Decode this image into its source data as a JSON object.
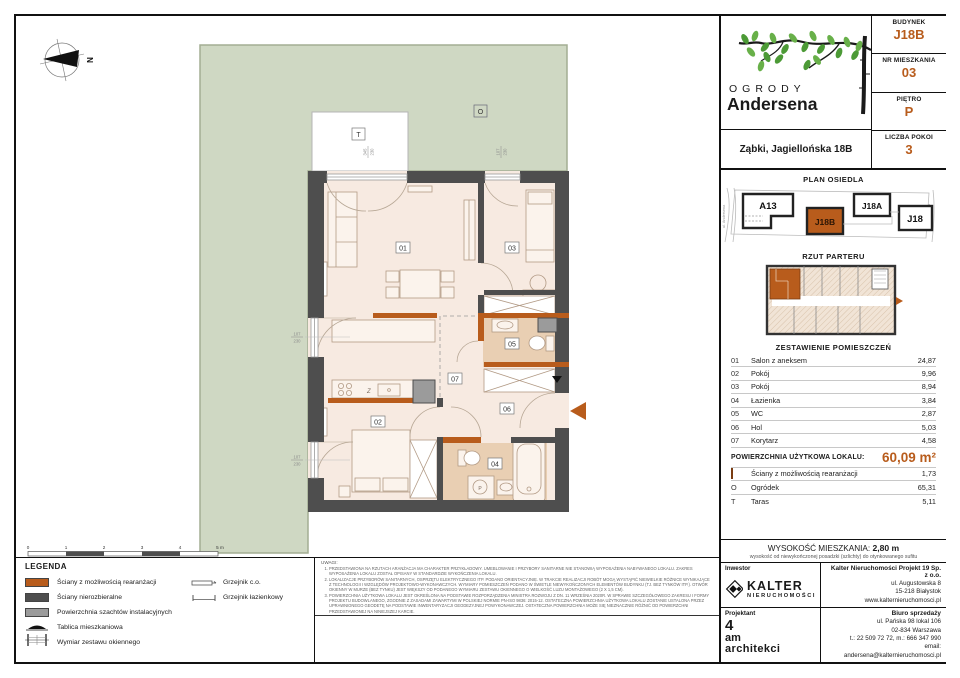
{
  "colors": {
    "accent": "#b85c1c",
    "wall": "#4e4e4e",
    "shaft": "#9b9b9b",
    "floor": "#f7eae1",
    "wet_floor": "#e9cfb3",
    "garden": "#cfd8c3"
  },
  "header": {
    "brand_top": "OGRODY",
    "brand_bottom": "Andersena",
    "address": "Ząbki, Jagiellońska 18B",
    "info": [
      {
        "label": "BUDYNEK",
        "value": "J18B"
      },
      {
        "label": "NR MIESZKANIA",
        "value": "03"
      },
      {
        "label": "PIĘTRO",
        "value": "P"
      },
      {
        "label": "LICZBA POKOI",
        "value": "3"
      }
    ]
  },
  "site_plan": {
    "title": "PLAN OSIEDLA",
    "street_left": "ul. Andersena",
    "street_right": "ul. Jagiellońska",
    "buildings": [
      "A13",
      "J18B",
      "J18A",
      "J18"
    ],
    "highlighted": "J18B"
  },
  "floor_overview": {
    "title": "RZUT PARTERU"
  },
  "rooms_table": {
    "title": "ZESTAWIENIE POMIESZCZEŃ",
    "rows": [
      {
        "no": "01",
        "name": "Salon z aneksem",
        "area": "24,87"
      },
      {
        "no": "02",
        "name": "Pokój",
        "area": "9,96"
      },
      {
        "no": "03",
        "name": "Pokój",
        "area": "8,94"
      },
      {
        "no": "04",
        "name": "Łazienka",
        "area": "3,84"
      },
      {
        "no": "05",
        "name": "WC",
        "area": "2,87"
      },
      {
        "no": "06",
        "name": "Hol",
        "area": "5,03"
      },
      {
        "no": "07",
        "name": "Korytarz",
        "area": "4,58"
      }
    ],
    "total_label": "POWIERZCHNIA UŻYTKOWA LOKALU:",
    "total_value": "60,09 m²",
    "extra_rows": [
      {
        "symbol": "",
        "label": "Ściany z możliwością rearanżacji",
        "area": "1,73"
      },
      {
        "symbol": "O",
        "label": "Ogródek",
        "area": "65,31"
      },
      {
        "symbol": "T",
        "label": "Taras",
        "area": "5,11"
      }
    ]
  },
  "height_note": {
    "label": "WYSOKOŚĆ MIESZKANIA:",
    "value": "2,80 m",
    "subtitle": "wysokość od niewykończonej posadzki (szlichty) do otynkowanego sufitu"
  },
  "footer": {
    "investor_label": "Inwestor",
    "designer_label": "Projektant",
    "kalter_name": "KALTER",
    "kalter_sub": "nieruchomości",
    "designer_lines": [
      "4",
      "am",
      "architekci"
    ],
    "company_name": "Kalter Nieruchomości Projekt 19 Sp. z o.o.",
    "company_lines": [
      "ul. Augustowska 8",
      "15-218 Białystok",
      "www.kalternieruchomosci.pl"
    ],
    "sales_name": "Biuro sprzedaży",
    "sales_lines": [
      "ul. Pańska 98 lokal 106",
      "02-834 Warszawa",
      "t.: 22 509 72 72, m.: 666 347 990",
      "email: andersena@kalternieruchomosci.pl"
    ]
  },
  "legend": {
    "title": "LEGENDA",
    "items": [
      "Ściany z możliwością rearanżacji",
      "Ściany nierozbieralne",
      "Powierzchnia szachtów instalacyjnych",
      "Tablica mieszkaniowa",
      "Wymiar zestawu okiennego"
    ],
    "radiators": [
      "Grzejnik c.o.",
      "Grzejnik łazienkowy"
    ]
  },
  "notes": {
    "title": "UWAGI:",
    "items": [
      "Przedstawiona na rzutach aranżacja ma charakter przykładowy. Umeblowanie i przybory sanitarne nie stanowią wyposażenia nabywanego lokalu. Zakres wyposażenia lokalu został opisany w standardzie wykończenia lokalu.",
      "Lokalizacje przyborów sanitarnych, osprzętu elektrycznego itp. podano orientacyjnie. W trakcie realizacji robót mogą wystąpić niewielkie różnice wynikające z technologii i względów projektowo-wykonawczych. Wymiary pomieszczeń podano w świetle niewykończonych elementów budynku (tj. bez tynków itp.). Otwór okienny w murze (bez tynku) jest większy od podanego wymiaru zestawu okiennego o wielkość luzu montażowego (2 x 1,5 cm).",
      "Powierzchnia użytkowa lokalu jest określona na podstawie Rozporządzenia Ministra Rozwoju z dn. 11 września 2020r. w sprawie szczegółowego zakresu i formy projektu budowlanego, zgodnie z zasadami zawartymi w Polskiej Normie PN-ISO 9836: 2015-12. Ostateczna powierzchnia użytkowa lokalu zostanie ustalona przez uprawnionego geodetę na podstawie inwentaryzacji geodezyjnej powykonawczej. Ostateczna powierzchnia może się nieznacznie różnić od powierzchni przedstawionej na niniejszej karcie.",
      "Niniejsza karta katalogowa została opracowana na podstawie projektu architektoniczno-budowlanego – nie stanowi ona wiernego odwzorowania powstałego lokalu mieszkalnego, a ma jedynie służyć wskazaniu uproszczonej aranżacji lokalu i jego pomieszczeń. W toku dalszego projektowania mogą wystąpić zmiany nieistotne (w rozumieniu prawa budowlanego) w stosunku do informacji zawartych w przedmiotowej karcie katalogowej lokalu, wynikające z obowiązujących przepisów, wiedzy technicznej i sztuki budowlanej.",
      "W częściach wspólnych budynku, przewidzianych do wyłącznego użytku dla właściciela lokalu, takich jak: ogródki, balkony, elewacje, miejsca postojowe, boksy rowerowe lub komórki lokatorskie, może występować wyposażenie i instalacje służące obsłudze całego budynku, do których klient będzie zobowiązany umożliwić dostęp.",
      "Niniejsza karta nie przedstawia kompletnego projektu wielobranżowego. Rysunek nie jest przeznaczony do celów wykonawczych. Szczegółowe informacje projektowe znajdują się w dokumentacji techniczno-wykonawczej dostępnej do wglądu dla klientów w biurze inwestora.",
      "Projekt chroniony prawem autorskim."
    ]
  },
  "plan": {
    "north_label": "N",
    "garden_label": "O",
    "terrace_label": "T",
    "room_labels": {
      "r01": "01",
      "r02": "02",
      "r03": "03",
      "r04": "04",
      "r05": "05",
      "r06": "06",
      "r07": "07"
    },
    "kitchen_symbol": "Z",
    "washer_symbol": "P",
    "window_dims": {
      "top_large": {
        "w": "345",
        "h": "230"
      },
      "top_small": {
        "w": "107",
        "h": "230"
      },
      "left_upper": {
        "w": "107",
        "h": "230"
      },
      "left_lower": {
        "w": "107",
        "h": "230"
      }
    },
    "scale_labels": [
      "0",
      "1",
      "2",
      "3",
      "4",
      "5 m"
    ]
  }
}
